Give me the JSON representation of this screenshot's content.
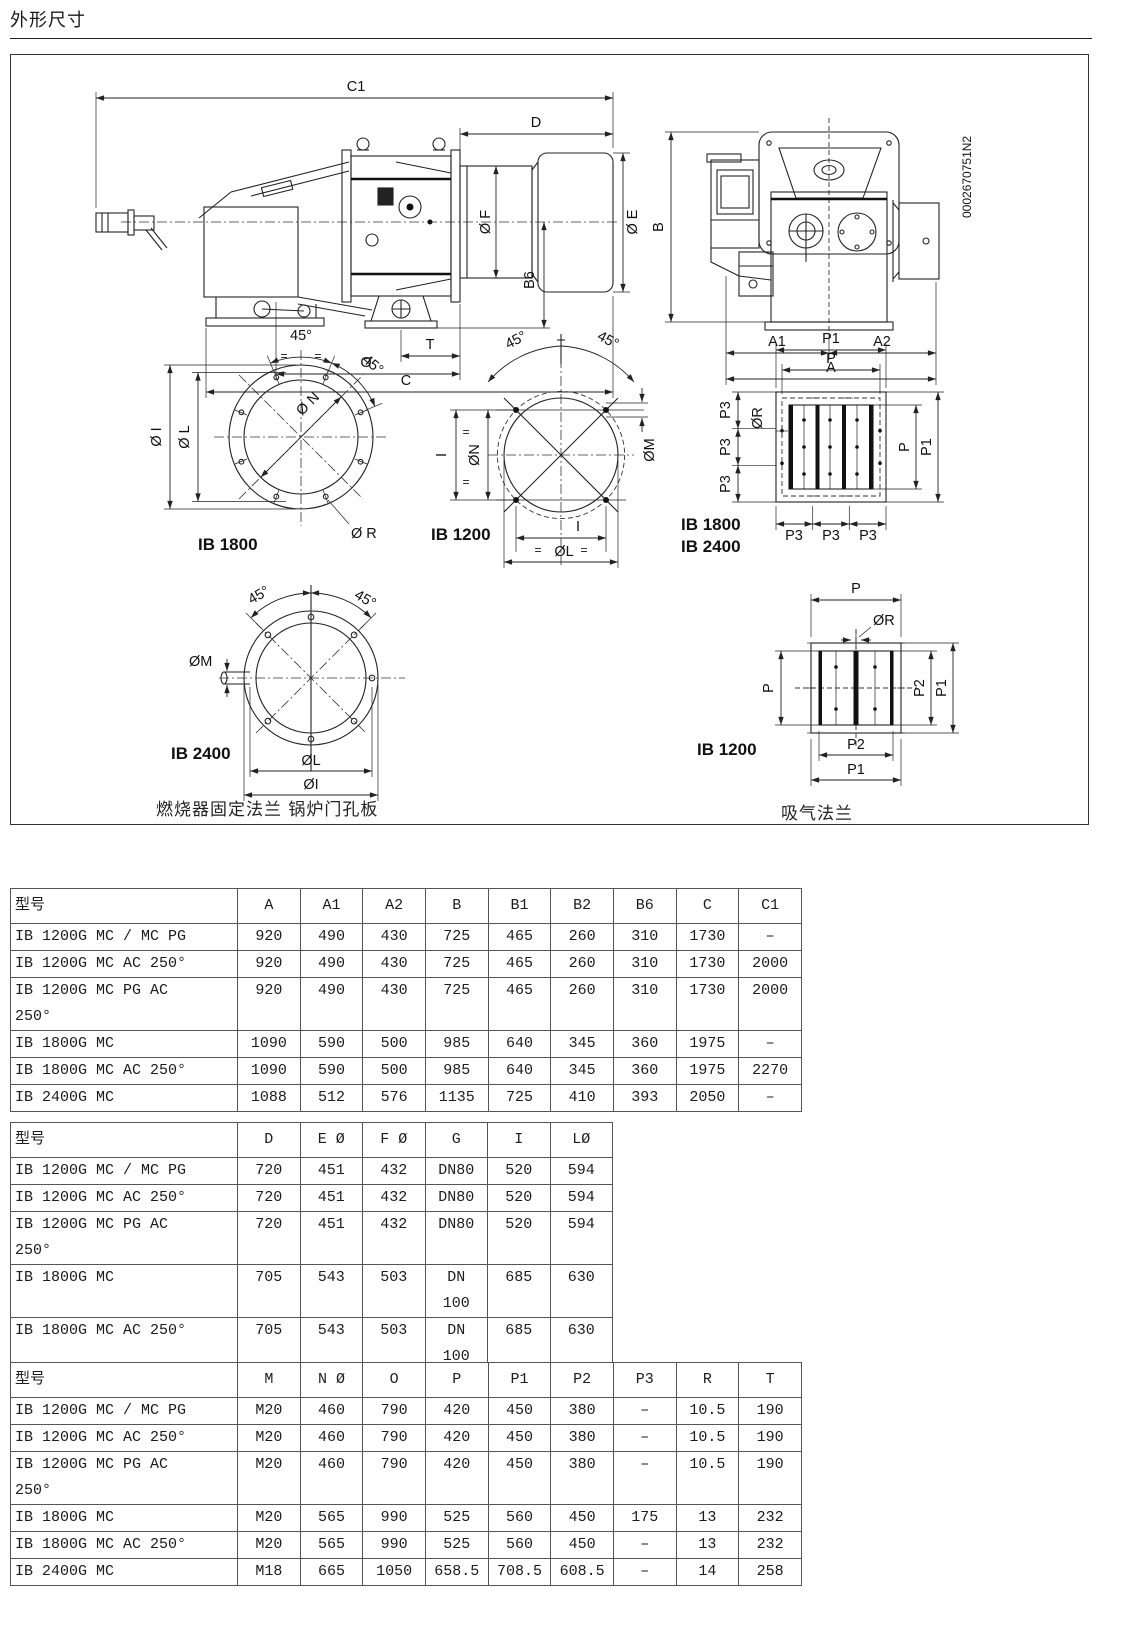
{
  "page": {
    "title": "外形尺寸",
    "caption_left": "燃烧器固定法兰 锅炉门孔板",
    "caption_right": "吸气法兰",
    "part_code": "0002670751N2"
  },
  "sym": {
    "deg45": "45°",
    "eq": "=",
    "p3": "P3"
  },
  "side_view": {
    "c1": "C1",
    "d": "D",
    "f": "Ø F",
    "e": "Ø E",
    "b6": "B6",
    "t": "T",
    "o": "O",
    "c": "C"
  },
  "rear_view": {
    "b": "B",
    "a1": "A1",
    "a2": "A2",
    "a": "A"
  },
  "flange_ib1800": {
    "title": "IB 1800",
    "oi": "Ø I",
    "ol": "Ø L",
    "on": "Ø N",
    "or": "Ø R"
  },
  "flange_ib1200": {
    "title": "IB 1200",
    "i": "I",
    "on": "ØN",
    "om": "ØM",
    "ol": "ØL"
  },
  "suction_big": {
    "title1": "IB 1800",
    "title2": "IB 2400",
    "p1": "P1",
    "p": "P",
    "or": "ØR"
  },
  "flange_ib2400": {
    "title": "IB 2400",
    "om": "ØM",
    "ol": "ØL",
    "oi": "ØI"
  },
  "suction_small": {
    "title": "IB 1200",
    "p": "P",
    "or": "ØR",
    "p1": "P1",
    "p2": "P2"
  },
  "tables": [
    {
      "headers": [
        "型号",
        "A",
        "A1",
        "A2",
        "B",
        "B1",
        "B2",
        "B6",
        "C",
        "C1"
      ],
      "rows": [
        [
          "IB 1200G MC / MC PG",
          "920",
          "490",
          "430",
          "725",
          "465",
          "260",
          "310",
          "1730",
          "–"
        ],
        [
          "IB 1200G MC AC 250°",
          "920",
          "490",
          "430",
          "725",
          "465",
          "260",
          "310",
          "1730",
          "2000"
        ],
        [
          "IB 1200G MC PG AC\n250°",
          "920",
          "490",
          "430",
          "725",
          "465",
          "260",
          "310",
          "1730",
          "2000"
        ],
        [
          "IB 1800G MC",
          "1090",
          "590",
          "500",
          "985",
          "640",
          "345",
          "360",
          "1975",
          "–"
        ],
        [
          "IB 1800G MC AC 250°",
          "1090",
          "590",
          "500",
          "985",
          "640",
          "345",
          "360",
          "1975",
          "2270"
        ],
        [
          "IB 2400G MC",
          "1088",
          "512",
          "576",
          "1135",
          "725",
          "410",
          "393",
          "2050",
          "–"
        ]
      ]
    },
    {
      "headers": [
        "型号",
        "D",
        "E Ø",
        "F Ø",
        "G",
        "I",
        "LØ"
      ],
      "rows": [
        [
          "IB 1200G MC / MC PG",
          "720",
          "451",
          "432",
          "DN80",
          "520",
          "594"
        ],
        [
          "IB 1200G MC AC 250°",
          "720",
          "451",
          "432",
          "DN80",
          "520",
          "594"
        ],
        [
          "IB 1200G MC PG AC\n250°",
          "720",
          "451",
          "432",
          "DN80",
          "520",
          "594"
        ],
        [
          "IB 1800G MC",
          "705",
          "543",
          "503",
          "DN 100",
          "685",
          "630"
        ],
        [
          "IB 1800G MC AC 250°",
          "705",
          "543",
          "503",
          "DN 100",
          "685",
          "630"
        ],
        [
          "IB 2400G MC",
          "642",
          "641",
          "652",
          "DN 125",
          "820",
          "772"
        ]
      ]
    },
    {
      "headers": [
        "型号",
        "M",
        "N Ø",
        "O",
        "P",
        "P1",
        "P2",
        "P3",
        "R",
        "T"
      ],
      "rows": [
        [
          "IB 1200G MC / MC PG",
          "M20",
          "460",
          "790",
          "420",
          "450",
          "380",
          "–",
          "10.5",
          "190"
        ],
        [
          "IB 1200G MC AC 250°",
          "M20",
          "460",
          "790",
          "420",
          "450",
          "380",
          "–",
          "10.5",
          "190"
        ],
        [
          "IB 1200G MC PG AC\n250°",
          "M20",
          "460",
          "790",
          "420",
          "450",
          "380",
          "–",
          "10.5",
          "190"
        ],
        [
          "IB 1800G MC",
          "M20",
          "565",
          "990",
          "525",
          "560",
          "450",
          "175",
          "13",
          "232"
        ],
        [
          "IB 1800G MC AC 250°",
          "M20",
          "565",
          "990",
          "525",
          "560",
          "450",
          "–",
          "13",
          "232"
        ],
        [
          "IB 2400G MC",
          "M18",
          "665",
          "1050",
          "658.5",
          "708.5",
          "608.5",
          "–",
          "14",
          "258"
        ]
      ]
    }
  ]
}
